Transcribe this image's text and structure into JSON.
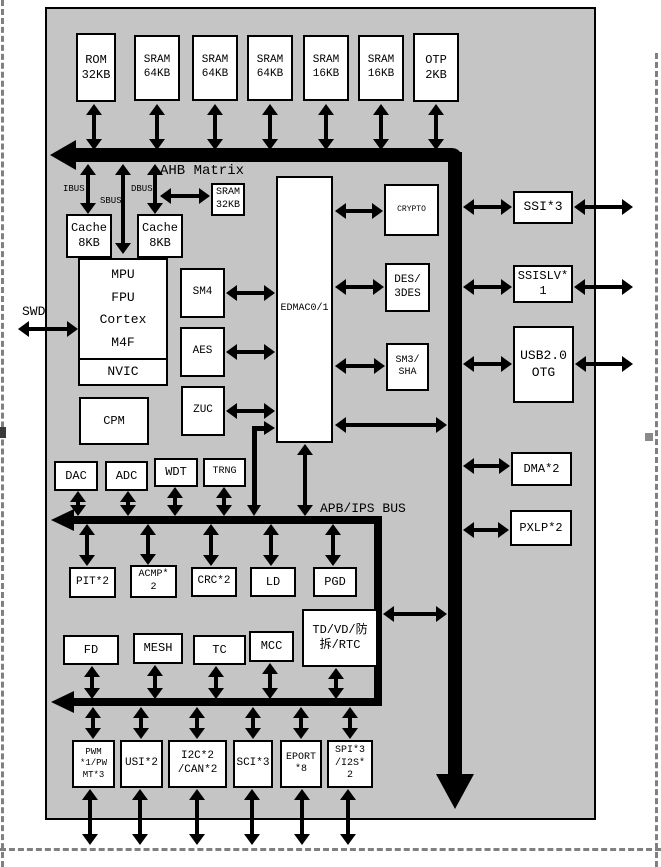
{
  "diagram": {
    "memory_row": [
      {
        "label": "ROM\n32KB"
      },
      {
        "label": "SRAM\n64KB"
      },
      {
        "label": "SRAM\n64KB"
      },
      {
        "label": "SRAM\n64KB"
      },
      {
        "label": "SRAM\n16KB"
      },
      {
        "label": "SRAM\n16KB"
      },
      {
        "label": "OTP\n2KB"
      }
    ],
    "bus_labels": {
      "ahb": "AHB Matrix",
      "ibus": "IBUS",
      "sbus": "SBUS",
      "dbus": "DBUS",
      "swd": "SWD",
      "apb": "APB/IPS BUS"
    },
    "cache": {
      "icache": "Cache\n8KB",
      "dcache": "Cache\n8KB",
      "sram32": "SRAM\n32KB"
    },
    "cpu": {
      "mpu": "MPU",
      "fpu": "FPU",
      "cortex": "Cortex",
      "core": "M4F",
      "nvic": "NVIC"
    },
    "cpm_label": "CPM",
    "crypto_accel": [
      {
        "label": "SM4"
      },
      {
        "label": "AES"
      },
      {
        "label": "ZUC"
      }
    ],
    "edmac_label": "EDMAC0/1",
    "crypto_blocks": [
      {
        "label": "CRYPTO"
      },
      {
        "label": "DES/\n3DES"
      },
      {
        "label": "SM3/\nSHA"
      }
    ],
    "right_ports": [
      {
        "label": "SSI*3"
      },
      {
        "label": "SSISLV*\n1"
      },
      {
        "label": "USB2.0\nOTG"
      }
    ],
    "dma_blocks": [
      {
        "label": "DMA*2"
      },
      {
        "label": "PXLP*2"
      }
    ],
    "analog_row": [
      {
        "label": "DAC"
      },
      {
        "label": "ADC"
      },
      {
        "label": "WDT"
      },
      {
        "label": "TRNG"
      }
    ],
    "apb_row1": [
      {
        "label": "PIT*2"
      },
      {
        "label": "ACMP*\n2"
      },
      {
        "label": "CRC*2"
      },
      {
        "label": "LD"
      },
      {
        "label": "PGD"
      }
    ],
    "apb_row2": [
      {
        "label": "FD"
      },
      {
        "label": "MESH"
      },
      {
        "label": "TC"
      },
      {
        "label": "MCC"
      },
      {
        "label": "TD/VD/防\n拆/RTC"
      }
    ],
    "io_row": [
      {
        "label": "PWM\n*1/PW\nMT*3"
      },
      {
        "label": "USI*2"
      },
      {
        "label": "I2C*2\n/CAN*2"
      },
      {
        "label": "SCI*3"
      },
      {
        "label": "EPORT\n*8"
      },
      {
        "label": "SPI*3\n/I2S*\n2"
      }
    ],
    "colors": {
      "chip_bg": "#c5c5c5",
      "box_bg": "#ffffff",
      "line": "#000000"
    }
  }
}
